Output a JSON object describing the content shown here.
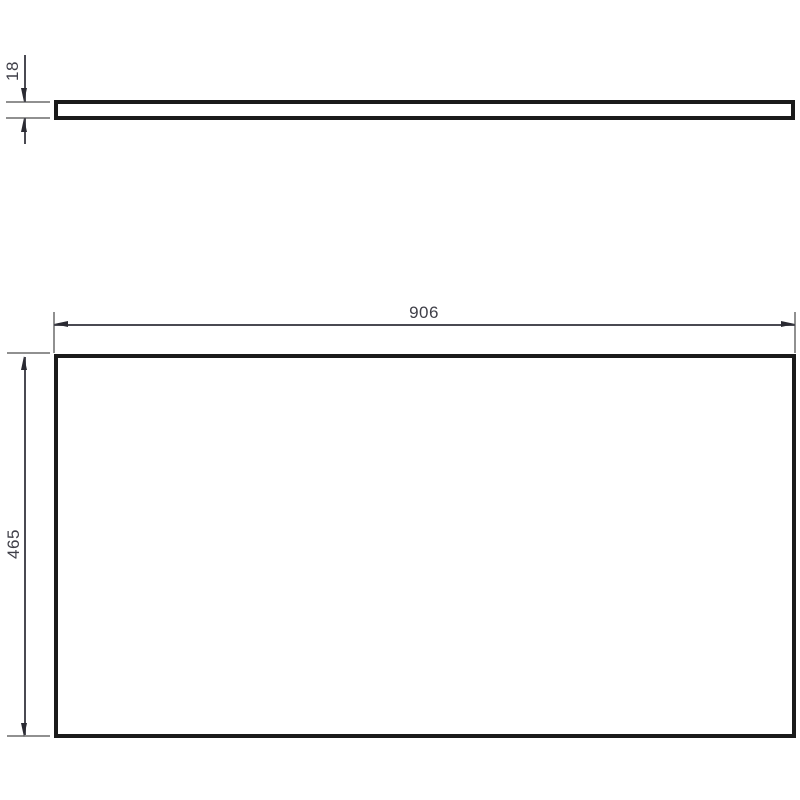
{
  "drawing": {
    "type": "technical-drawing",
    "views": {
      "top_view": {
        "description": "panel edge profile",
        "thickness": {
          "label": "18"
        }
      },
      "front_view": {
        "description": "panel face",
        "width": {
          "label": "906"
        },
        "height": {
          "label": "465"
        }
      }
    },
    "colors": {
      "background": "#ffffff",
      "outline": "#1a1a1a",
      "dimension_line": "#4a4a52",
      "extension_line": "#909090",
      "arrow": "#2a2a32",
      "text": "#3f3f48"
    }
  }
}
